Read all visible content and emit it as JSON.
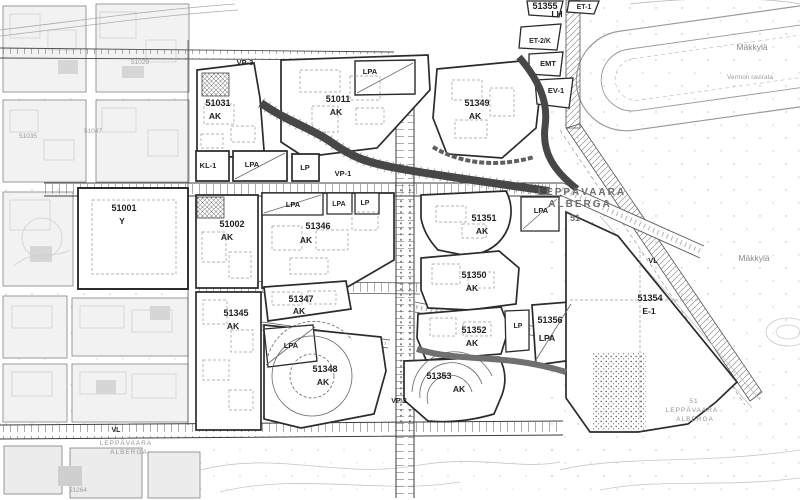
{
  "map": {
    "region_titles": {
      "main_1": "LEPPÄVAARA",
      "main_2": "ALBERGA",
      "main_number": "51",
      "southwest_1": "LEPPÄVAARA",
      "southwest_2": "ALBERGA",
      "southeast_number": "51",
      "southeast_1": "LEPPÄVAARA",
      "southeast_2": "ALBERGA"
    },
    "place_names": {
      "makkyla_north": "Mäkkylä",
      "racetrack": "Vermon ravirata",
      "makkyla_east": "Mäkkylä"
    },
    "parcels": [
      {
        "code": "51001",
        "zone": "Y"
      },
      {
        "code": "51002",
        "zone": "AK"
      },
      {
        "code": "51011",
        "zone": "AK"
      },
      {
        "code": "51031",
        "zone": "AK"
      },
      {
        "code": "51345",
        "zone": "AK"
      },
      {
        "code": "51346",
        "zone": "AK"
      },
      {
        "code": "51347",
        "zone": "AK"
      },
      {
        "code": "51348",
        "zone": "AK"
      },
      {
        "code": "51349",
        "zone": "AK"
      },
      {
        "code": "51350",
        "zone": "AK"
      },
      {
        "code": "51351",
        "zone": "AK"
      },
      {
        "code": "51352",
        "zone": "AK"
      },
      {
        "code": "51353",
        "zone": "AK"
      },
      {
        "code": "51354",
        "zone": "E-1"
      },
      {
        "code": "51355",
        "zone": "LH"
      },
      {
        "code": "51356",
        "zone": "LPA"
      }
    ],
    "zone_marks": [
      "VP-3",
      "LPA",
      "KL-1",
      "LPA",
      "LP",
      "VP-1",
      "LPA",
      "LPA",
      "LP",
      "LPA",
      "LP",
      "LPA",
      "VP-2",
      "VL",
      "VL",
      "EMT",
      "EV-1",
      "ET-1",
      "ET-2/K"
    ],
    "faint_parcel_numbers": [
      "51029",
      "51035",
      "51047",
      "51264"
    ]
  }
}
